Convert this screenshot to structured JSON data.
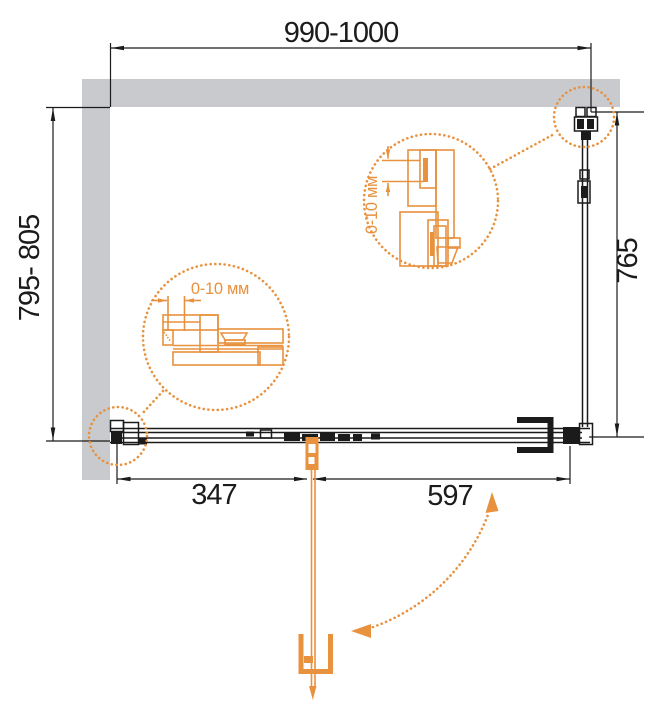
{
  "drawing": {
    "type": "technical-plan-view",
    "subject": "shower enclosure with hinged door",
    "dimensions": {
      "top_width": "990-1000",
      "left_depth": "795- 805",
      "right_height": "765",
      "bottom_left_segment": "347",
      "bottom_right_segment": "597"
    },
    "callouts": {
      "left_label": "0-10 мм",
      "right_label": "0-10 мм"
    },
    "colors": {
      "line": "#1b1b1b",
      "wall_fill": "#c8cacd",
      "accent_orange": "#e8913e",
      "background": "#ffffff"
    }
  }
}
